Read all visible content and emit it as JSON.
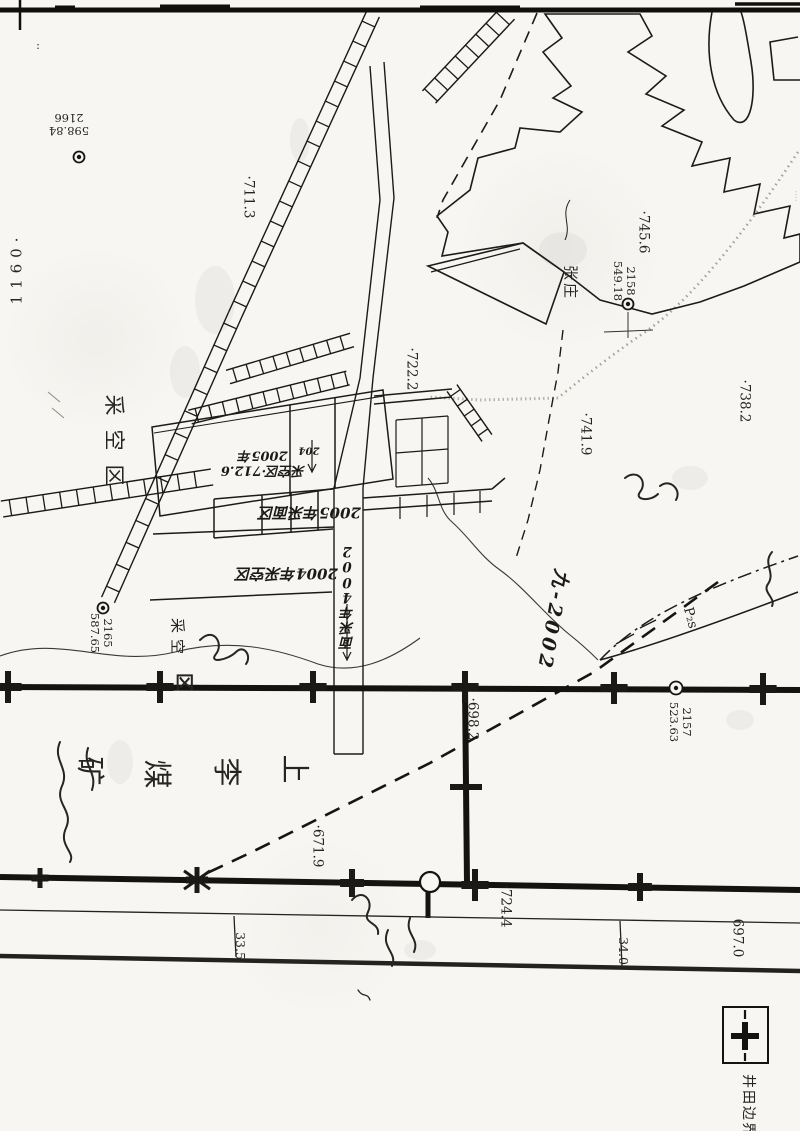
{
  "map": {
    "legend": {
      "label": "井田边界",
      "symbol": "boundary-cross-line"
    },
    "mine_name": "上李煤矿",
    "labels": [
      {
        "id": "sheet-number",
        "text": "1160·",
        "x": 17,
        "y": 268,
        "rot": -90,
        "size": 15,
        "ls": 6,
        "cls": "print"
      },
      {
        "id": "corner-colon",
        "text": ":",
        "x": 38,
        "y": 46,
        "rot": 0,
        "size": 11,
        "cls": "print"
      },
      {
        "id": "survey-label-2166",
        "lines": [
          "2166",
          "598.84"
        ],
        "x": 69,
        "y": 124,
        "rot": 180,
        "size": 11.5,
        "cls": "print"
      },
      {
        "id": "survey-label-2158",
        "lines": [
          "2158",
          "549.18"
        ],
        "x": 624,
        "y": 281,
        "rot": 90,
        "size": 11.5,
        "cls": "print"
      },
      {
        "id": "survey-label-2165",
        "lines": [
          "2165",
          "587.65"
        ],
        "x": 101,
        "y": 633,
        "rot": 90,
        "size": 11.5,
        "cls": "print"
      },
      {
        "id": "survey-label-2157",
        "lines": [
          "2157",
          "523.63"
        ],
        "x": 680,
        "y": 722,
        "rot": 90,
        "size": 11.5,
        "cls": "print"
      },
      {
        "id": "elevation-711-3",
        "text": "·711.3",
        "x": 248,
        "y": 197,
        "rot": 90,
        "size": 13.5,
        "cls": "print"
      },
      {
        "id": "elevation-722-2",
        "text": "·722.2",
        "x": 411,
        "y": 369,
        "rot": 90,
        "size": 13.5,
        "cls": "print"
      },
      {
        "id": "elevation-745-6",
        "text": "·745.6",
        "x": 643,
        "y": 232,
        "rot": 90,
        "size": 13.5,
        "cls": "print"
      },
      {
        "id": "elevation-741-9",
        "text": "·741.9",
        "x": 585,
        "y": 434,
        "rot": 90,
        "size": 13.5,
        "cls": "print"
      },
      {
        "id": "elevation-738-2",
        "text": "·738.2",
        "x": 744,
        "y": 401,
        "rot": 90,
        "size": 13.5,
        "cls": "print"
      },
      {
        "id": "elevation-698-2",
        "text": "·698.2",
        "x": 472,
        "y": 719,
        "rot": 90,
        "size": 13.5,
        "cls": "print"
      },
      {
        "id": "elevation-671-9",
        "text": "·671.9",
        "x": 317,
        "y": 846,
        "rot": 90,
        "size": 13.5,
        "cls": "print"
      },
      {
        "id": "elevation-724-4",
        "text": "·724.4",
        "x": 505,
        "y": 906,
        "rot": 90,
        "size": 13.5,
        "cls": "print"
      },
      {
        "id": "elevation-697-0",
        "text": "697.0",
        "x": 737,
        "y": 938,
        "rot": 90,
        "size": 13.5,
        "cls": "print"
      },
      {
        "id": "dimension-33-5",
        "text": "33.5",
        "x": 240,
        "y": 946,
        "rot": 90,
        "size": 12.5,
        "cls": "print"
      },
      {
        "id": "dimension-34-0",
        "text": "34.0",
        "x": 623,
        "y": 951,
        "rot": 90,
        "size": 12.5,
        "cls": "print"
      },
      {
        "id": "village-zhangzhuang",
        "text": "张庄",
        "x": 570,
        "y": 283,
        "rot": 90,
        "size": 15,
        "ls": 3,
        "cls": "print"
      },
      {
        "id": "mined-out-area-1",
        "text": "采空区",
        "x": 113,
        "y": 447,
        "rot": 90,
        "size": 21,
        "ls": 14,
        "cls": "print"
      },
      {
        "id": "mined-out-area-2",
        "text": "采空",
        "x": 177,
        "y": 639,
        "rot": 90,
        "size": 15,
        "ls": 6,
        "cls": "print"
      },
      {
        "id": "mined-out-area-2-qu",
        "text": "区",
        "x": 183,
        "y": 682,
        "rot": 90,
        "size": 18,
        "cls": "print boldc"
      },
      {
        "id": "mine-name-kuang",
        "text": "矿",
        "x": 90,
        "y": 771,
        "rot": 90,
        "size": 29,
        "cls": "print"
      },
      {
        "id": "mine-name-mei",
        "text": "煤",
        "x": 157,
        "y": 774,
        "rot": 90,
        "size": 29,
        "cls": "print"
      },
      {
        "id": "mine-name-li",
        "text": "李",
        "x": 227,
        "y": 772,
        "rot": 90,
        "size": 29,
        "cls": "print"
      },
      {
        "id": "mine-name-shang",
        "text": "上",
        "x": 295,
        "y": 769,
        "rot": 90,
        "size": 29,
        "cls": "print"
      },
      {
        "id": "note-2005-panel",
        "lines": [
          "2005年",
          "采空区·712.6"
        ],
        "x": 263,
        "y": 462,
        "rot": 180,
        "size": 13,
        "cls": "hand"
      },
      {
        "id": "note-2005-face-row",
        "text": "2005年采面区",
        "x": 310,
        "y": 512,
        "rot": 180,
        "size": 15,
        "cls": "hand"
      },
      {
        "id": "note-2004-goaf",
        "text": "2004年采空区",
        "x": 287,
        "y": 573,
        "rot": 180,
        "size": 15,
        "cls": "hand"
      },
      {
        "id": "note-2004-face-col",
        "text": "2004年采面",
        "x": 347,
        "y": 596,
        "rot": 180,
        "vertical": true,
        "size": 13.5,
        "cls": "hand"
      },
      {
        "id": "note-204",
        "text": "204",
        "x": 309,
        "y": 450,
        "rot": 180,
        "size": 10,
        "cls": "hand"
      },
      {
        "id": "note-jiu-2002",
        "text": "九-2002",
        "x": 552,
        "y": 620,
        "rot": 100,
        "size": 19,
        "ls": 4,
        "cls": "hand"
      },
      {
        "id": "strata-p2s",
        "text": "P₂s",
        "x": 690,
        "y": 618,
        "rot": 75,
        "size": 13.5,
        "cls": "print"
      },
      {
        "id": "legend-boundary-label",
        "text": "井田边界",
        "x": 747,
        "y": 1106,
        "rot": 90,
        "size": 14,
        "ls": 2,
        "cls": "print"
      },
      {
        "id": "edge-marks",
        "text": "····",
        "x": 795,
        "y": 196,
        "rot": 90,
        "size": 9,
        "cls": "faint"
      }
    ],
    "ladders": [
      {
        "id": "main-incline-upper",
        "x1": 373,
        "y1": 14,
        "x2": 235,
        "y2": 315,
        "hw": 7,
        "step": 22
      },
      {
        "id": "main-incline-lower",
        "x1": 235,
        "y1": 315,
        "x2": 108,
        "y2": 600,
        "hw": 7,
        "step": 24
      },
      {
        "id": "top-right-roadway",
        "x1": 508,
        "y1": 13,
        "x2": 429,
        "y2": 97,
        "hw": 9,
        "step": 15
      },
      {
        "id": "left-horizontal-roadway",
        "x1": 2,
        "y1": 509,
        "x2": 212,
        "y2": 477,
        "hw": 8,
        "step": 17
      },
      {
        "id": "panel-band-1",
        "x1": 190,
        "y1": 417,
        "x2": 348,
        "y2": 378,
        "hw": 7,
        "step": 14
      },
      {
        "id": "panel-band-2",
        "x1": 228,
        "y1": 377,
        "x2": 352,
        "y2": 340,
        "hw": 7,
        "step": 14
      },
      {
        "id": "northeast-roadway",
        "x1": 452,
        "y1": 388,
        "x2": 487,
        "y2": 438,
        "hw": 6,
        "step": 12
      }
    ],
    "survey_points": [
      {
        "id": "survey-point-2166",
        "x": 79,
        "y": 157,
        "r": 5.5
      },
      {
        "id": "survey-point-2158",
        "x": 628,
        "y": 304,
        "r": 5.5
      },
      {
        "id": "survey-point-2165",
        "x": 103,
        "y": 608,
        "r": 5.5
      },
      {
        "id": "survey-point-2157",
        "x": 676,
        "y": 688,
        "r": 6.5
      }
    ],
    "boundary_crosses": [
      {
        "id": "h1-cross-1",
        "x": 8,
        "y": 687,
        "arm": 16,
        "w": 6
      },
      {
        "id": "h1-cross-2",
        "x": 160,
        "y": 687,
        "arm": 16,
        "w": 6
      },
      {
        "id": "h1-cross-3",
        "x": 313,
        "y": 687,
        "arm": 16,
        "w": 6
      },
      {
        "id": "h1-cross-4",
        "x": 465,
        "y": 687,
        "arm": 16,
        "w": 6
      },
      {
        "id": "h1-cross-5",
        "x": 614,
        "y": 688,
        "arm": 16,
        "w": 6
      },
      {
        "id": "h1-cross-6",
        "x": 763,
        "y": 689,
        "arm": 16,
        "w": 6
      },
      {
        "id": "v1-cross",
        "x": 466,
        "y": 787,
        "arm": 16,
        "w": 6,
        "horiz": true
      },
      {
        "id": "h2-cross-1",
        "x": 40,
        "y": 878,
        "arm": 10,
        "w": 5
      },
      {
        "id": "h2-cross-2",
        "x": 197,
        "y": 880,
        "arm": 13,
        "w": 5,
        "diag": true
      },
      {
        "id": "h2-cross-3",
        "x": 352,
        "y": 883,
        "arm": 14,
        "w": 6
      },
      {
        "id": "h2-cross-4",
        "x": 475,
        "y": 885,
        "arm": 16,
        "w": 6
      },
      {
        "id": "h2-cross-5",
        "x": 640,
        "y": 887,
        "arm": 14,
        "w": 6
      }
    ]
  }
}
